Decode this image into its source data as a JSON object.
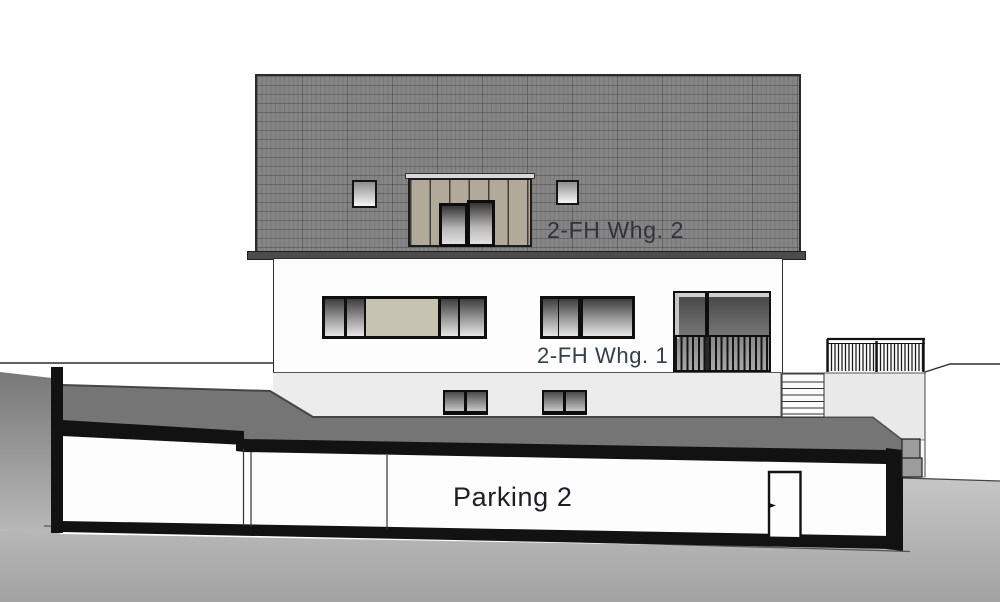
{
  "drawing": {
    "kind": "building elevation and section",
    "labels": {
      "attic": {
        "text": "2-FH Whg. 2"
      },
      "upper": {
        "text": "2-FH Whg. 1"
      },
      "parking": {
        "text": "Parking 2"
      }
    },
    "colors": {
      "roof": "#858585",
      "roof_joint_lines": "#5f5f5f",
      "eave": "#4c4c4c",
      "dormer_cladding": "#b1a999",
      "window_panel_beige": "#c7c3b3",
      "facade_upper": "#fdfdfd",
      "facade_ground": "#ececec",
      "terrace": "#e9e9e9",
      "terrain_dark": "#757575",
      "soil_top": "#c4c4c4",
      "soil_bottom": "#a2a2a2",
      "section_cut_black": "#121212",
      "label_dark": "#31404a"
    }
  }
}
